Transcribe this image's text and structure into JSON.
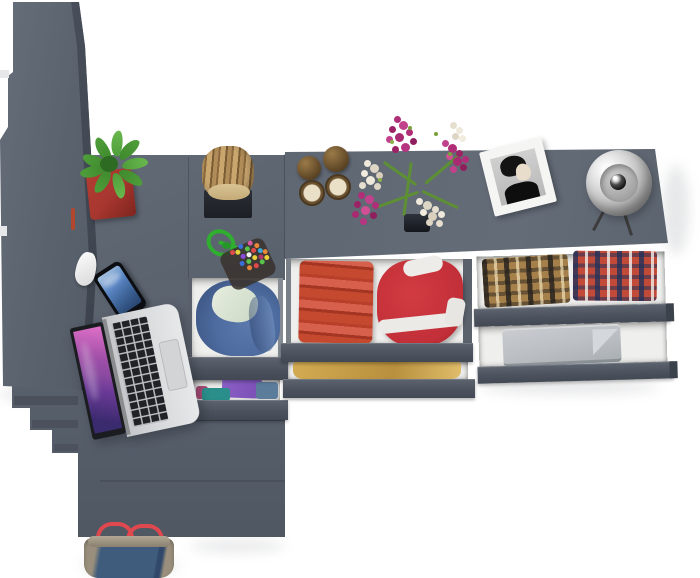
{
  "scene": {
    "type": "3d-furniture-render",
    "description": "Top-down view of a dark gray corner desk, wardrobe and dresser with pulled-out drawers of folded clothes, a laptop, smartphone, potted plant, wooden log, hourglasses, flower bouquet, framed portrait, dome lamp and a denim handbag",
    "background": "#ffffff"
  },
  "colors": {
    "bg": "#ffffff",
    "furniture-top": "#5d6571",
    "furniture-top-light": "#68707c",
    "furniture-side": "#424954",
    "drawer-front": "#4d5460",
    "drawer-interior": "#efefed",
    "plant-green": "#4f9d3a",
    "pot-red": "#a83730",
    "log-wood": "#b08c58",
    "brass": "#6b5230",
    "sand": "#eae0c8",
    "flower-magenta": "#b02d78",
    "flower-white": "#efe9dc",
    "stem-green": "#5d8f34",
    "frame-white": "#f5f5f3",
    "lamp-silver": "#c9c9c9",
    "laptop-silver": "#d5d7d9",
    "screen-purple": "#8a4aa0",
    "phone-screen-blue": "#5b87c5",
    "hoodie-blue": "#4e6ca0",
    "fold-purple": "#7a4fb5",
    "fold-teal": "#2a8f8a",
    "red-towel": "#c5492f",
    "red-jacket": "#c22f38",
    "yellow-fold": "#d3ab52",
    "plaid-brown": "#a5804a",
    "plaid-red": "#c24a38",
    "gray-fold": "#bcc0c4",
    "bag-denim": "#3f5c7d",
    "bag-trim": "#9a8f7c",
    "bag-strap": "#e0484f",
    "cord-green": "#2fae2f"
  },
  "objects": {
    "wardrobe": {
      "label": "Tall gray wardrobe seen from above"
    },
    "desk": {
      "label": "Gray corner desk"
    },
    "dresser": {
      "label": "Gray dresser with open drawers"
    },
    "plant": {
      "label": "Green plant in red pot"
    },
    "log": {
      "label": "Decorative wooden log on black tray"
    },
    "hourglasses": {
      "label": "Two brass hourglasses"
    },
    "flowers": {
      "label": "Magenta and white flower bouquet"
    },
    "photo_frame": {
      "label": "White framed black-and-white portrait"
    },
    "lamp": {
      "label": "Silver dome desk lamp"
    },
    "smartphone": {
      "label": "Smartphone with blue screen"
    },
    "earbud_case": {
      "label": "Small white case"
    },
    "laptop": {
      "label": "Open silver laptop with purple wallpaper"
    },
    "keychain": {
      "label": "Beaded keychain with green cord"
    },
    "drawer_hoodie": {
      "label": "Drawer with blue hooded sweatshirt"
    },
    "drawer_folded": {
      "label": "Drawer with purple and teal folded clothes"
    },
    "drawer_red": {
      "label": "Drawer with red towels and striped red jacket"
    },
    "drawer_yellow": {
      "label": "Drawer with yellow folded clothes"
    },
    "drawer_plaid": {
      "label": "Drawer with two folded plaid shirts"
    },
    "drawer_gray": {
      "label": "Drawer with gray folded linens"
    },
    "handbag": {
      "label": "Denim and tan handbag with red straps"
    }
  }
}
